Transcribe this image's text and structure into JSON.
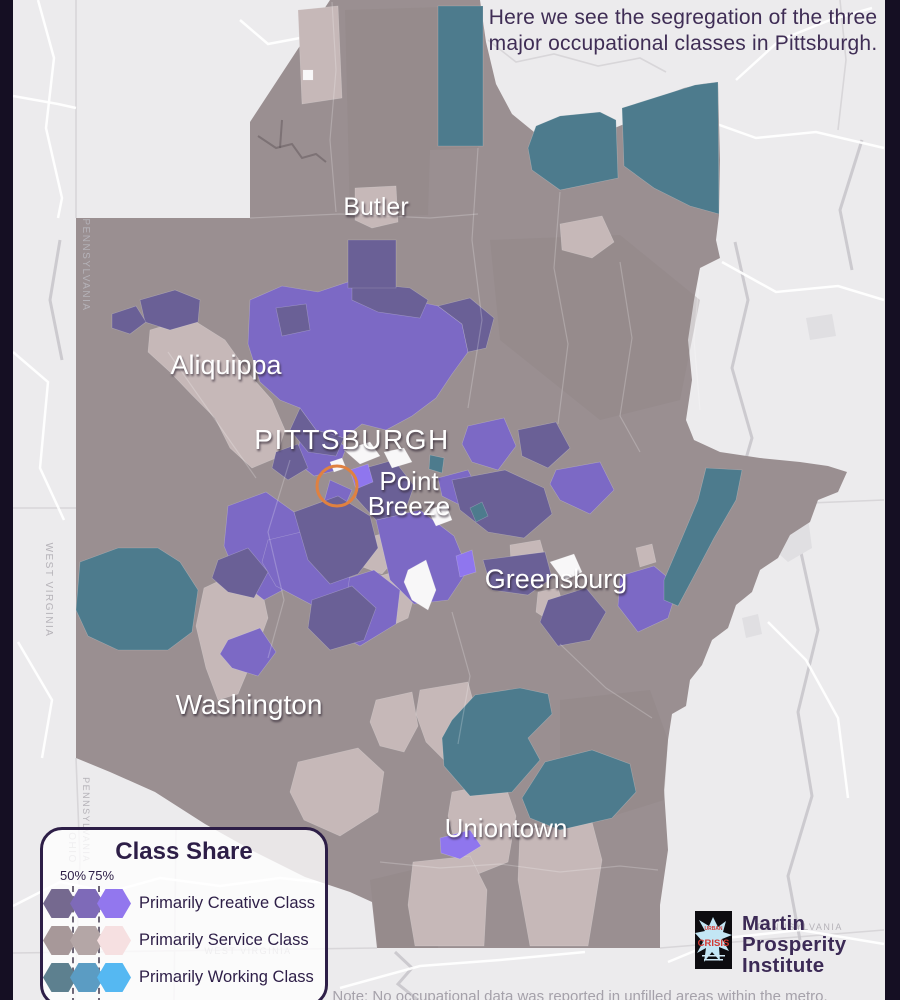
{
  "header": {
    "line1": "Here we see the segregation of the three",
    "line2": "major occupational classes in Pittsburgh."
  },
  "note": "Note: No occupational data was reported in unfilled areas within the metro.",
  "legend": {
    "title": "Class Share",
    "thresholds": [
      "50%",
      "75%"
    ],
    "rows": [
      {
        "label": "Primarily Creative Class",
        "colors": [
          "#75698f",
          "#7e6ab8",
          "#9277ee"
        ]
      },
      {
        "label": "Primarily Service Class",
        "colors": [
          "#a79899",
          "#b4a6a6",
          "#f6e0e1"
        ]
      },
      {
        "label": "Primarily Working Class",
        "colors": [
          "#5d808f",
          "#5b9cc3",
          "#55b8f2"
        ]
      }
    ]
  },
  "logo": {
    "book_top": "URBAN",
    "book_title": "CRISIS",
    "org_lines": [
      "Martin",
      "Prosperity",
      "Institute"
    ]
  },
  "map": {
    "colors": {
      "bg": "#ecebed",
      "base": "#9a8f91",
      "bar": "#150f23",
      "working": "#4d7b8d",
      "creative_dark": "#6a6096",
      "creative_mid": "#7c69c5",
      "creative_bright": "#8f76ee",
      "service_light": "#c6b8b8",
      "service_pink": "#f0dede",
      "no_data": "#f8f7f8",
      "road": "#ffffff",
      "line": "#d8d6d9",
      "river": "#c9c7cb",
      "town": "#e0dfe2",
      "shade": "#8b8183",
      "focus": "#e08140",
      "city_text": "#ffffff",
      "state_text": "#b5b2b8"
    },
    "outline": "76,218 250,218 250,122 330,0 480,0 486,42 496,84 512,114 534,132 564,140 600,134 634,120 652,104 668,94 684,88 702,84 718,82 720,160 719,215 716,240 720,258 712,262 700,268 694,300 688,340 692,380 686,420 694,440 720,452 760,458 800,462 828,466 847,472 838,492 818,500 810,522 790,535 778,558 760,570 752,592 736,605 728,628 712,640 702,665 690,680 686,706 672,714 668,740 664,790 668,850 660,905 660,948 377,948 372,902 350,892 305,877 255,852 205,824 155,792 110,772 76,758",
    "shades": [
      "560,700 650,690 668,740 664,800 600,820 560,780",
      "370,880 420,868 440,900 438,948 378,948",
      "490,240 620,235 700,300 680,400 600,420 500,340",
      "345,10 478,6 478,148 430,150 428,215 350,218"
    ],
    "regions": [
      {
        "cls": "service_light",
        "pts": "150,330 190,318 225,340 250,375 272,400 285,430 276,458 252,468 230,448 215,418 192,395 170,372 148,352"
      },
      {
        "cls": "service_light",
        "pts": "298,10 338,6 342,98 302,104"
      },
      {
        "cls": "service_light",
        "pts": "355,188 396,186 398,222 372,228 355,220"
      },
      {
        "cls": "service_light",
        "pts": "560,224 602,216 614,242 592,258 562,250"
      },
      {
        "cls": "service_light",
        "pts": "204,588 238,572 262,590 268,618 254,656 238,694 218,700 206,668 196,626"
      },
      {
        "cls": "service_light",
        "pts": "344,586 394,572 416,590 408,618 378,632 348,616"
      },
      {
        "cls": "service_light",
        "pts": "420,690 468,682 478,720 470,754 446,762 426,742 416,714"
      },
      {
        "cls": "service_light",
        "pts": "452,792 504,782 516,816 508,862 478,874 456,846 448,816"
      },
      {
        "cls": "service_light",
        "pts": "520,830 592,822 602,860 594,910 588,946 530,946 518,880"
      },
      {
        "cls": "service_light",
        "pts": "376,700 412,692 418,726 404,752 380,746 370,722"
      },
      {
        "cls": "service_light",
        "pts": "298,762 358,748 384,772 378,812 340,836 304,820 290,792"
      },
      {
        "cls": "service_light",
        "pts": "413,862 470,856 487,890 484,946 415,946 408,905"
      },
      {
        "cls": "service_light",
        "pts": "510,545 540,540 548,568 534,590 512,582"
      },
      {
        "cls": "service_light",
        "pts": "538,592 558,588 564,608 548,620 536,612"
      },
      {
        "cls": "service_light",
        "pts": "636,548 652,544 656,562 640,567"
      },
      {
        "cls": "service_light",
        "pts": "360,540 388,532 398,556 382,574 360,566"
      },
      {
        "cls": "service_pink",
        "pts": "394,530 412,524 418,542 402,549"
      },
      {
        "cls": "service_pink",
        "pts": "420,560 438,554 444,572 427,579"
      },
      {
        "cls": "creative_mid",
        "pts": "250,300 282,286 318,292 348,282 384,292 410,300 438,306 462,324 468,352 452,374 436,398 412,416 386,430 362,424 344,438 316,430 300,408 280,400 260,382 248,344"
      },
      {
        "cls": "creative_mid",
        "pts": "300,440 330,432 346,448 338,470 314,476 296,462"
      },
      {
        "cls": "creative_mid",
        "pts": "468,426 504,418 516,446 498,470 472,462 462,444"
      },
      {
        "cls": "creative_mid",
        "pts": "556,470 600,462 614,490 590,514 560,500 550,484"
      },
      {
        "cls": "creative_mid",
        "pts": "228,506 266,492 294,512 308,548 294,584 264,600 238,580 224,546"
      },
      {
        "cls": "creative_mid",
        "pts": "330,584 374,570 400,590 396,624 360,646 330,630 322,606"
      },
      {
        "cls": "creative_mid",
        "pts": "376,520 420,510 454,536 468,570 448,600 414,604 390,580"
      },
      {
        "cls": "creative_mid",
        "pts": "268,540 318,528 354,548 348,588 314,606 276,586 262,562"
      },
      {
        "cls": "creative_mid",
        "pts": "228,640 260,628 276,652 258,676 232,668 220,654"
      },
      {
        "cls": "creative_mid",
        "pts": "438,478 468,470 478,490 462,506 442,496"
      },
      {
        "cls": "creative_mid",
        "pts": "620,576 654,566 678,586 668,618 638,632 618,606"
      },
      {
        "cls": "creative_mid",
        "pts": "330,480 352,490 344,508 324,502"
      },
      {
        "cls": "creative_dark",
        "pts": "140,300 175,290 200,300 198,322 170,330 145,322"
      },
      {
        "cls": "creative_dark",
        "pts": "112,314 136,306 146,322 130,334 112,328"
      },
      {
        "cls": "creative_dark",
        "pts": "276,308 306,304 310,330 282,336"
      },
      {
        "cls": "creative_dark",
        "pts": "352,282 410,288 428,300 420,318 378,312 352,300"
      },
      {
        "cls": "creative_dark",
        "pts": "438,306 470,298 494,318 486,348 468,352 462,324"
      },
      {
        "cls": "creative_dark",
        "pts": "300,408 316,430 344,438 336,456 308,452 290,430"
      },
      {
        "cls": "creative_dark",
        "pts": "348,240 396,240 396,288 348,288"
      },
      {
        "cls": "creative_dark",
        "pts": "276,452 298,444 308,468 288,480 272,468"
      },
      {
        "cls": "creative_dark",
        "pts": "518,430 556,422 570,448 548,468 522,456"
      },
      {
        "cls": "creative_dark",
        "pts": "294,512 338,496 370,516 378,548 358,574 330,584 308,560"
      },
      {
        "cls": "creative_dark",
        "pts": "358,470 394,460 414,486 404,514 376,520 356,498"
      },
      {
        "cls": "creative_dark",
        "pts": "218,560 248,548 268,572 254,598 228,592 212,578"
      },
      {
        "cls": "creative_dark",
        "pts": "312,600 352,586 376,608 364,640 330,650 308,628"
      },
      {
        "cls": "creative_dark",
        "pts": "452,480 505,470 544,488 552,514 524,538 488,532 460,510"
      },
      {
        "cls": "creative_dark",
        "pts": "483,560 545,552 552,578 528,595 492,590"
      },
      {
        "cls": "creative_dark",
        "pts": "548,600 586,588 606,612 590,640 558,646 540,622"
      },
      {
        "cls": "creative_bright",
        "pts": "350,470 368,464 373,482 356,489"
      },
      {
        "cls": "creative_bright",
        "pts": "456,556 472,550 476,572 460,577"
      },
      {
        "cls": "creative_bright",
        "pts": "440,838 470,830 481,846 460,859 441,853"
      },
      {
        "cls": "working",
        "pts": "438,6 483,6 483,146 438,146"
      },
      {
        "cls": "working",
        "pts": "528,148 536,126 560,116 600,112 616,120 618,178 560,190 532,170"
      },
      {
        "cls": "working",
        "pts": "622,108 660,96 695,85 718,82 719,214 690,206 654,188 624,166"
      },
      {
        "cls": "working",
        "pts": "706,468 742,470 736,500 714,538 694,576 678,606 664,600 664,580 682,538 698,500"
      },
      {
        "cls": "working",
        "pts": "80,562 118,548 158,548 180,562 198,590 192,632 168,650 118,650 88,636 76,610"
      },
      {
        "cls": "working",
        "pts": "452,720 475,695 520,688 548,694 552,714 528,738 540,760 512,792 470,796 444,766 442,738"
      },
      {
        "cls": "working",
        "pts": "522,798 545,762 592,750 630,764 636,792 612,818 560,830 530,818"
      },
      {
        "cls": "working",
        "pts": "430,455 444,458 442,473 429,469"
      },
      {
        "cls": "working",
        "pts": "470,508 482,502 488,516 476,522"
      },
      {
        "cls": "no_data",
        "pts": "344,450 370,442 380,456 360,464"
      },
      {
        "cls": "no_data",
        "pts": "384,452 404,448 412,462 392,468"
      },
      {
        "cls": "no_data",
        "pts": "408,570 426,560 436,590 428,610 412,600 404,582"
      },
      {
        "cls": "no_data",
        "pts": "550,562 574,554 582,572 564,581"
      },
      {
        "cls": "no_data",
        "pts": "428,510 446,504 452,520 436,526"
      },
      {
        "cls": "no_data",
        "pts": "330,462 342,458 346,468 334,472"
      },
      {
        "cls": "no_data",
        "pts": "303,70 313,70 313,80 303,80"
      }
    ],
    "roads": [
      "13,96 58,104 76,108",
      "38,0 54,58 46,128 62,198 58,218",
      "13,352 48,382 40,468 64,520",
      "18,642 52,700 42,758",
      "240,20 268,44 300,38",
      "700,118 756,138 816,132 884,148",
      "736,80 780,40 830,20 872,8",
      "722,262 776,292 838,286 884,300",
      "768,622 806,660 838,718 848,798",
      "668,962 726,938 800,930 884,944",
      "340,988 420,966 500,960 585,952",
      "13,906 60,882 110,892 160,878 220,886 280,878 336,884"
    ],
    "lines": [
      "13,508 76,508",
      "760,505 884,500",
      "13,953 377,948",
      "660,948 884,930",
      "176,830 174,1000",
      "488,40 516,62 554,54 598,66 640,58 666,72",
      "840,0 846,60 838,130",
      "76,0 76,218",
      "76,758 80,860 75,1000"
    ],
    "rivers": [
      "735,242 748,300 732,368 752,438 745,462",
      "820,470 800,548 818,630 798,712 812,796 788,876 800,940",
      "395,952 412,968 398,984 418,1000",
      "60,240 50,300 62,360",
      "862,140 840,210 852,270"
    ],
    "towns": [
      "772,508 806,502 812,548 788,562 768,544",
      "806,318 832,314 836,336 810,340",
      "742,618 758,614 762,634 746,638"
    ],
    "county_lines": [
      "250,218 340,214 430,218 478,214",
      "478,148 472,240 482,320 468,408",
      "332,2 336,70 330,140 336,212",
      "560,192 554,268 568,344 558,424",
      "620,262 632,338 620,416 640,452",
      "290,460 268,532 284,600 268,658",
      "452,612 470,676 458,744",
      "560,644 606,688 652,718",
      "380,862 440,868 500,864 560,872 620,866 658,870",
      "168,352 214,418 256,478",
      "700,270 694,340 700,410"
    ],
    "metro_rivers": [
      "258,136 276,148 292,144 302,158 316,154 326,162",
      "282,120 280,148"
    ],
    "state_labels": [
      {
        "text": "PENNSYLVANIA",
        "x": 83,
        "y": 265,
        "rotate": 90,
        "size": 10
      },
      {
        "text": "PENNSYLVANIA",
        "x": 83,
        "y": 820,
        "rotate": 90,
        "size": 9
      },
      {
        "text": "OHIO",
        "x": 69,
        "y": 848,
        "rotate": 90,
        "size": 10
      },
      {
        "text": "WEST VIRGINIA",
        "x": 46,
        "y": 590,
        "rotate": 90,
        "size": 10
      },
      {
        "text": "WEST VIRGINIA",
        "x": 248,
        "y": 954,
        "rotate": 0,
        "size": 9
      },
      {
        "text": "PENNSYLVANIA",
        "x": 800,
        "y": 930,
        "rotate": 0,
        "size": 9
      }
    ],
    "city_labels": [
      {
        "name": "Butler",
        "x": 376,
        "y": 215,
        "size": 25
      },
      {
        "name": "Aliquippa",
        "x": 226,
        "y": 374,
        "size": 27
      },
      {
        "name": "PITTSBURGH",
        "x": 352,
        "y": 449,
        "size": 28,
        "spacing": 1.5
      },
      {
        "name": "Point",
        "x": 409,
        "y": 490,
        "size": 26
      },
      {
        "name": "Breeze",
        "x": 409,
        "y": 515,
        "size": 26
      },
      {
        "name": "Greensburg",
        "x": 556,
        "y": 588,
        "size": 27
      },
      {
        "name": "Washington",
        "x": 249,
        "y": 714,
        "size": 28
      },
      {
        "name": "Uniontown",
        "x": 506,
        "y": 837,
        "size": 26
      }
    ],
    "focus_circle": {
      "cx": 337,
      "cy": 486,
      "r": 20
    }
  }
}
